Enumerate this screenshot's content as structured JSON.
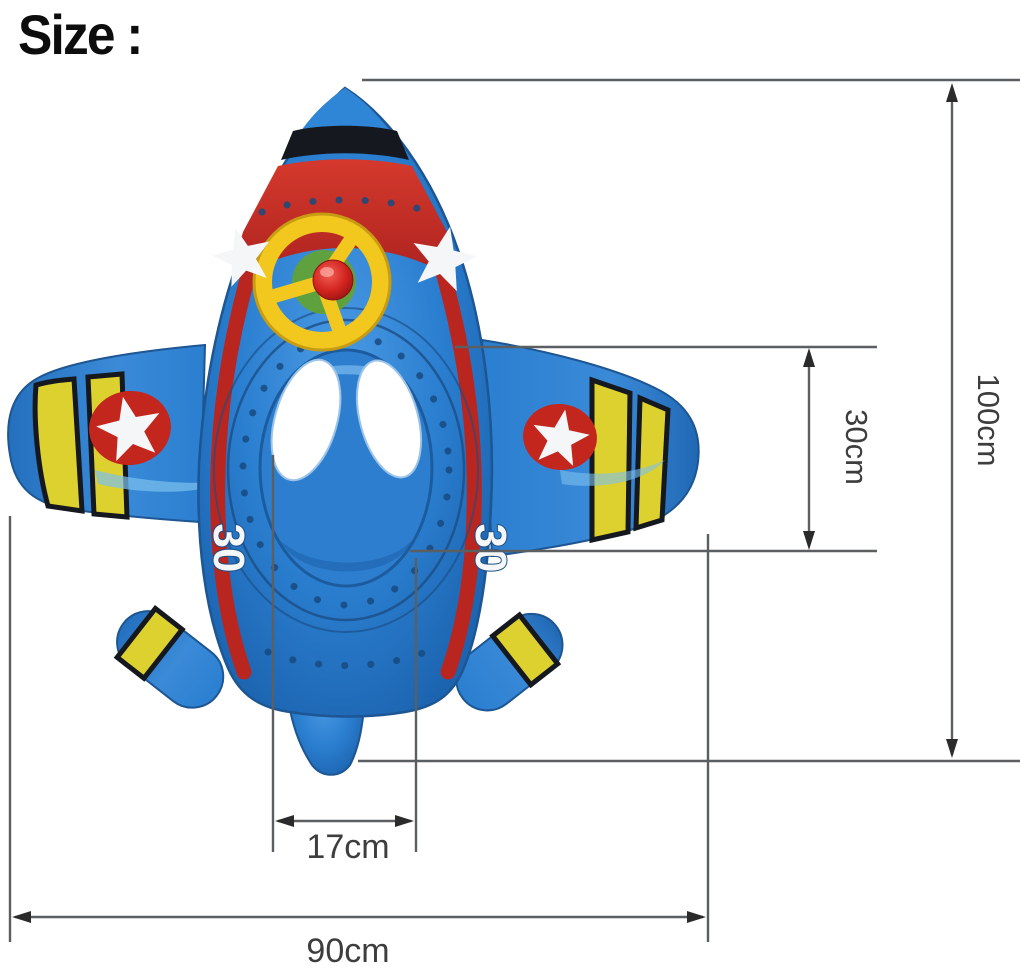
{
  "page_title": "Size :",
  "dimensions": {
    "overall_height": "100cm",
    "cockpit_depth": "30cm",
    "seat_width": "17cm",
    "overall_width": "90cm"
  },
  "float_markings": {
    "left_side_number": "30",
    "right_side_number": "30"
  },
  "colors": {
    "float_blue": "#2b7fd0",
    "float_red": "#c9302a",
    "float_yellow": "#e8d334",
    "dimension_line": "#5b5f62",
    "dimension_text": "#3d3d3d",
    "title_text": "#0d0d0d",
    "background": "#ffffff"
  }
}
